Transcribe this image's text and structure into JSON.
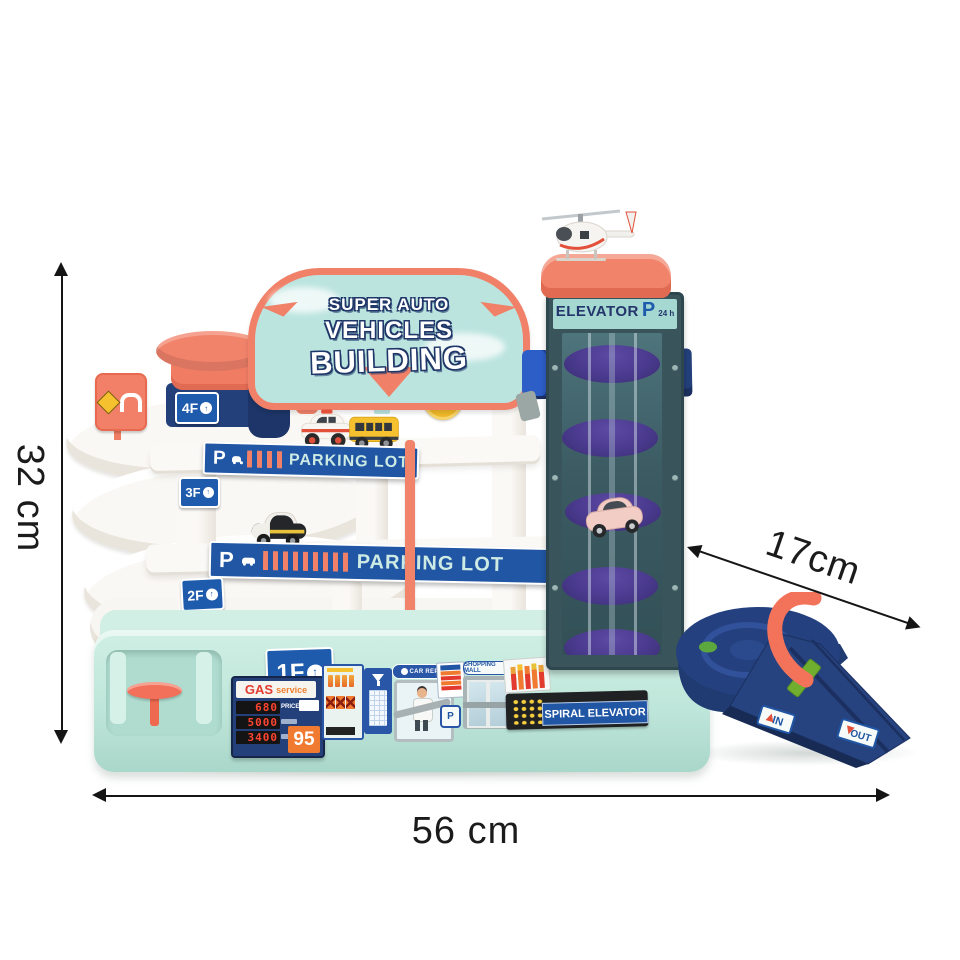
{
  "measurements": {
    "height": "32 cm",
    "width": "56 cm",
    "depth": "17cm"
  },
  "billboard": {
    "line1": "SUPER AUTO",
    "line2": "VEHICLES",
    "line3": "BUILDING"
  },
  "elevator_tower": {
    "banner_title": "ELEVATOR",
    "banner_p": "P",
    "banner_hours": "24 h"
  },
  "roof_badge": {
    "value": "24"
  },
  "floor_labels": {
    "f4": "4F",
    "f3": "3F",
    "f2": "2F",
    "f1": "1F"
  },
  "parking_banner": {
    "p": "P",
    "label": "PARKING LOT"
  },
  "gas_station": {
    "title": "GAS",
    "subtitle": "service",
    "row1_value": "680",
    "row1_label": "PRICE",
    "row2_value": "5000",
    "row3_value": "3400",
    "octane": "95"
  },
  "service_signs": {
    "car_repair": "CAR REPAIR",
    "shopping_mall": "SHOPPING MALL",
    "spiral_elevator": "SPIRAL ELEVATOR",
    "parking_badge": "P"
  },
  "ramp_labels": {
    "in_label": "IN",
    "out_label": "OUT"
  },
  "icons": {
    "up_arrow": "↑"
  },
  "colors": {
    "coral": "#F2836B",
    "navy": "#24407B",
    "banner_blue": "#2156A4",
    "mint": "#C2E8DD",
    "sign_teal": "#BCE4DF",
    "purple": "#4A3A8E",
    "bus_yellow": "#F5C12E",
    "ink": "#111111"
  }
}
